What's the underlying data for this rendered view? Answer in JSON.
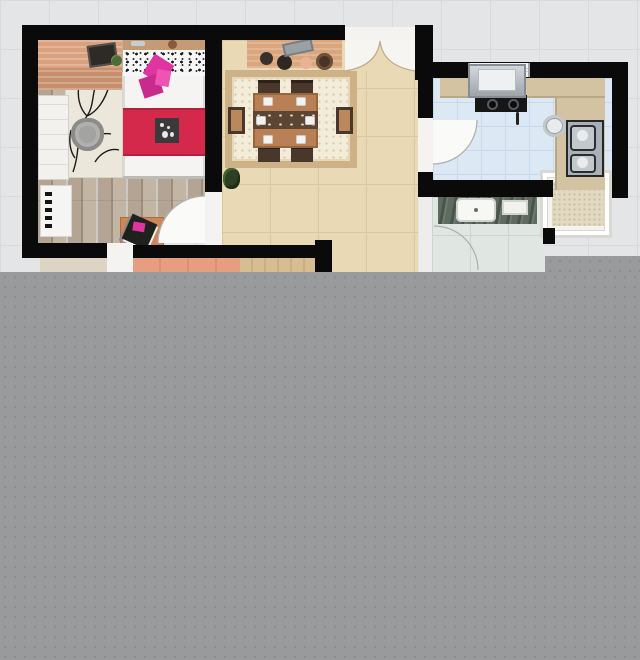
{
  "meta": {
    "kind": "floor-plan-screenshot",
    "width": 640,
    "height": 660,
    "visible_text": "none"
  },
  "colors": {
    "background": "#e4e5e7",
    "grid_line": "#d7d8da",
    "wall": "#0a0a0a",
    "overlay": "#989a9c",
    "overlay_dot": "#898b8d",
    "door_white": "#f4f3f1",
    "arc_line": "#b3b1ac",
    "window": "#f2f5f7",
    "bedroom_floor": "#b3a493",
    "plank_dark": "#9c8d7d",
    "plank_light": "#c3b5a4",
    "plank_dark2": "#a3948359",
    "rug_cream": "#ebe7db",
    "ottoman": "#a3a3a1",
    "bed_white": "#f5f4f2",
    "bed_red": "#d5294b",
    "pink": "#df35a0",
    "pink2": "#c92a8e",
    "headboard": "#c59b76",
    "desk": "#d9a17d",
    "desk2": "#c88f6c",
    "wardrobe": "#f2f1ee",
    "dining_floor": "#e9dab5",
    "dining_line": "#dcc69e",
    "rug_border": "#cdb287",
    "rug_field": "#f3ecd9",
    "table": "#b97f55",
    "table_edge": "#96663f",
    "chair": "#4a372c",
    "chair_seat": "#b9885c",
    "runner": "#5c4533",
    "sideboard": "#d9a67e",
    "kitchen_floor": "#dde8f5",
    "kitchen_line": "#c9d9ec",
    "kitchen_ext": "#e0d6bd",
    "counter": "#d3c3a3",
    "counter_edge": "#b8a888",
    "stove": "#161616",
    "steel": "#aab1b6",
    "sink_face": "#c2c8cc",
    "bath_floor": "#e0e7e2",
    "bath_line": "#ccd6ce",
    "vanity": "#5f6a60",
    "vanity_dark": "#49544b",
    "sink_white": "#f7f7f5",
    "balcony_frame": "#f3f3f0",
    "balcony_border": "#d9d8d3",
    "mat": "#e3d9c1",
    "salmon": "#e79e80",
    "salmon_dark": "#dd9172",
    "tan_floor": "#d8bd93",
    "tan_dark": "#cbae82",
    "hall_floor": "#ddd4c3",
    "plant": "#4e6b3a",
    "plant2": "#2c4123"
  },
  "legend": {
    "rooms": [
      {
        "id": "bedroom",
        "features": [
          "double-bed",
          "desk",
          "wardrobe",
          "radiator",
          "branch-pattern-rug",
          "ottoman",
          "magazine-table"
        ]
      },
      {
        "id": "dining-room",
        "features": [
          "dining-table",
          "six-chairs",
          "ornate-rug",
          "sideboard",
          "plant",
          "double-door-arch"
        ]
      },
      {
        "id": "kitchen",
        "features": [
          "range-hood",
          "cooktop",
          "double-sink",
          "counters",
          "window",
          "door-swing"
        ]
      },
      {
        "id": "bathroom",
        "features": [
          "vanity",
          "sink",
          "tray",
          "door-swing"
        ]
      },
      {
        "id": "balcony",
        "features": [
          "mat"
        ]
      },
      {
        "id": "partial-rooms-bottom",
        "features": [
          "hallway-floor",
          "salmon-wood-floor",
          "tan-wood-floor"
        ]
      }
    ],
    "overlay": "gray dotted placeholder covering lower portion of image"
  }
}
